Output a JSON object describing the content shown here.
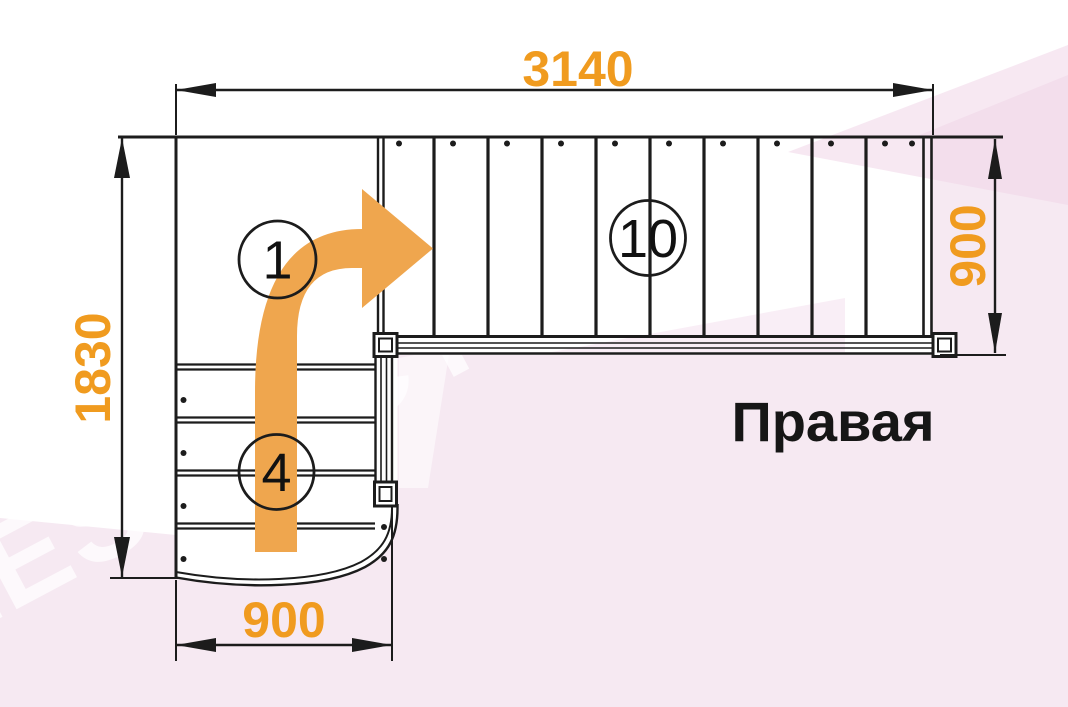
{
  "title": "Правая",
  "watermark": "LESTNICY-PROSTO.RU",
  "dims": {
    "top": "3140",
    "left": "1830",
    "right": "900",
    "bottom": "900"
  },
  "steps": {
    "start": "1",
    "upper": "10",
    "lower": "4"
  },
  "colors": {
    "dimension_text": "#F09B1F",
    "arrow_fill": "#EFA64E",
    "line": "#1C1C1C",
    "background_tint": "#F6E9F2"
  }
}
